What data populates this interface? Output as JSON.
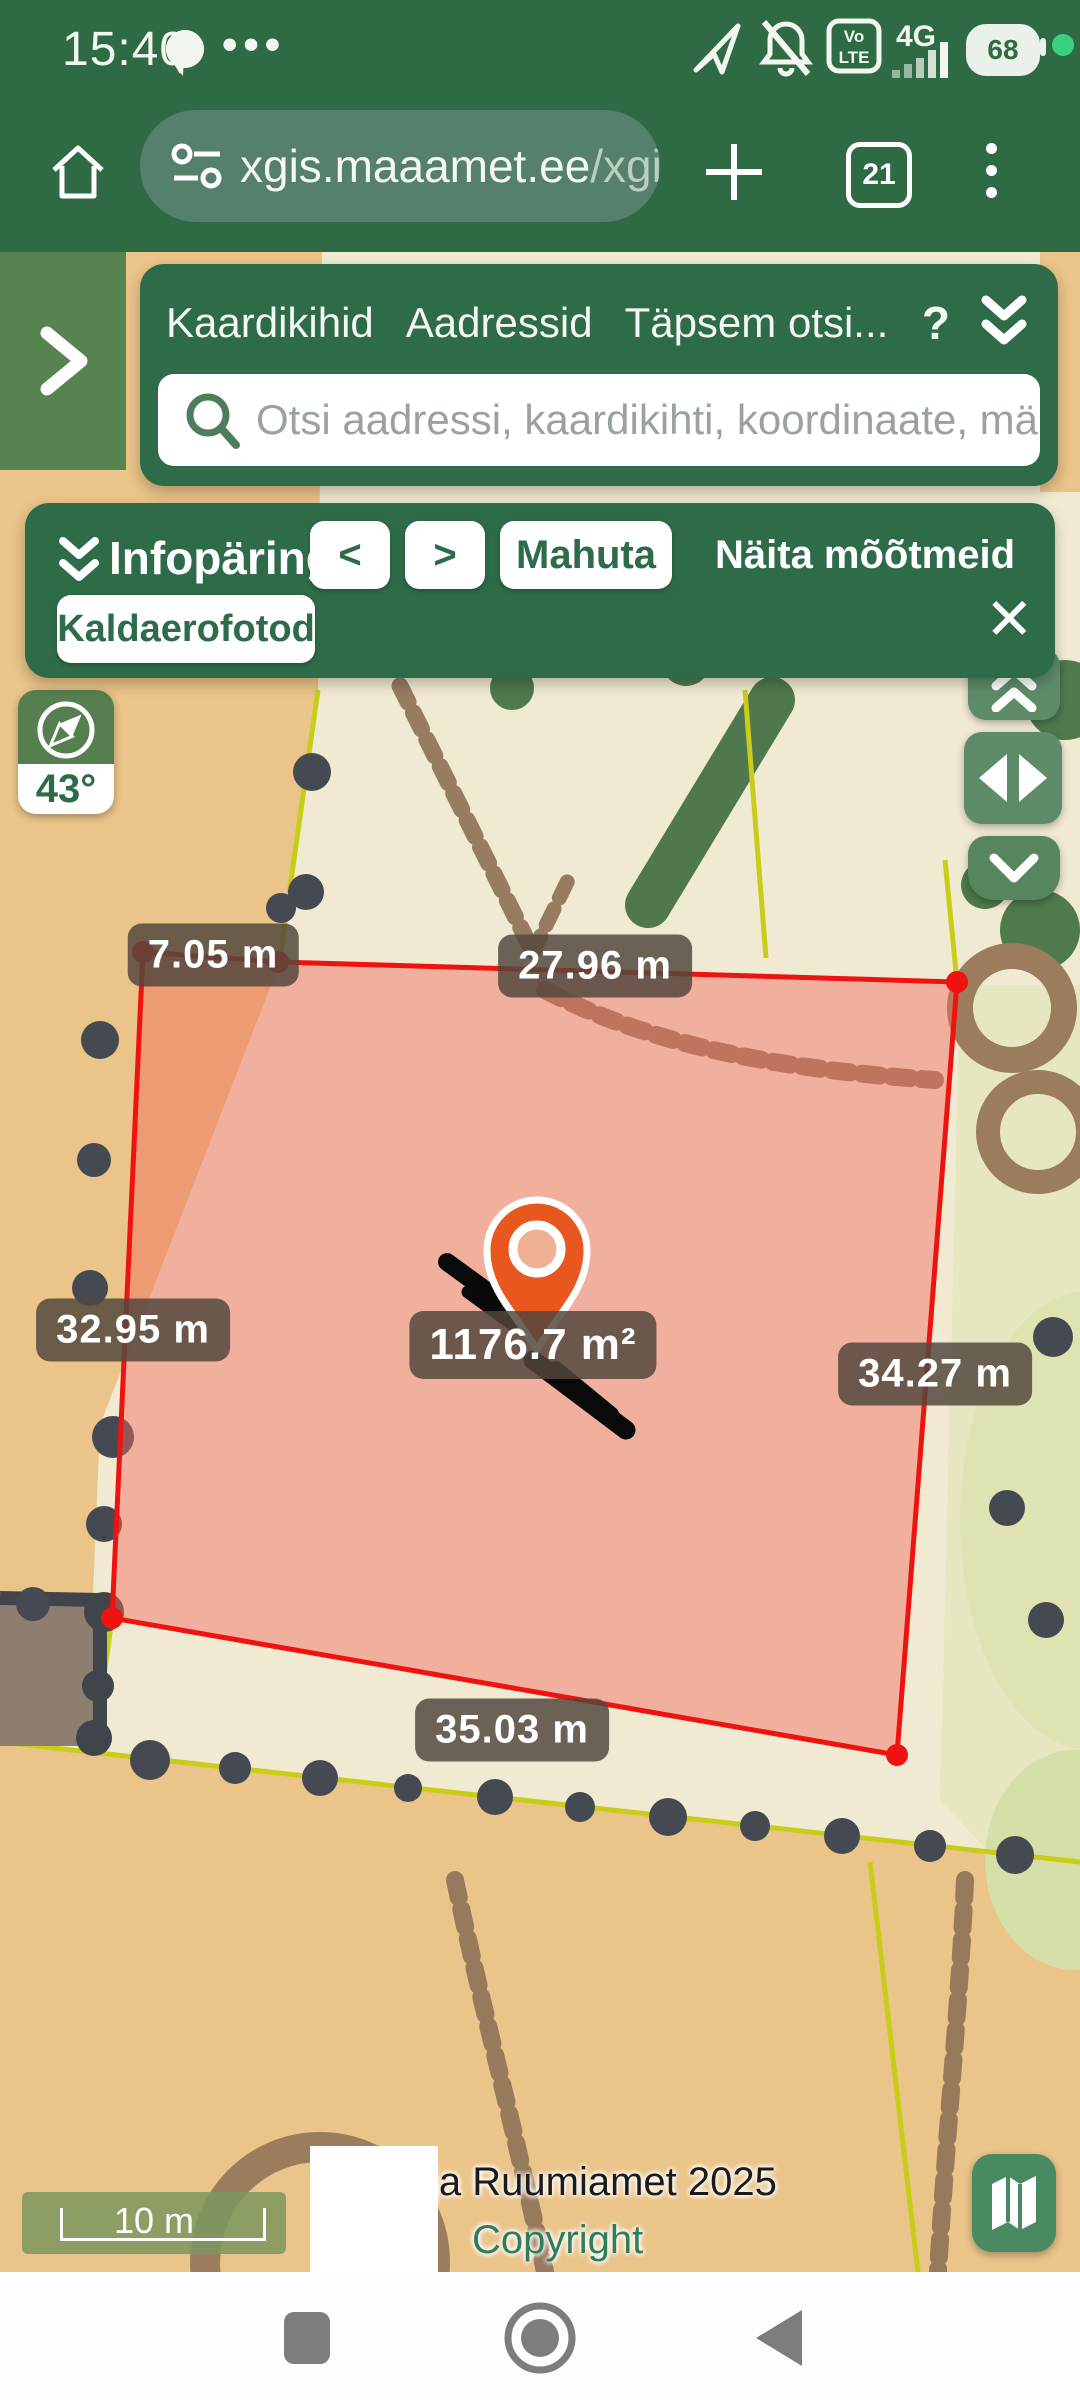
{
  "status_bar": {
    "time": "15:40",
    "overflow_dots": "•••",
    "volte_line1": "Vo",
    "volte_line2": "LTE",
    "network": "4G",
    "battery_percent": "68"
  },
  "browser": {
    "url_host": "xgis.maaamet.ee",
    "url_path": "/xgis:",
    "tab_count": "21"
  },
  "layer_panel": {
    "tabs": [
      "Kaardikihid",
      "Aadressid",
      "Täpsem otsi..."
    ],
    "help_label": "?",
    "search_placeholder": "Otsi aadressi, kaardikihti, koordinaate, mär..."
  },
  "info_panel": {
    "title": "Infopäring",
    "prev_label": "<",
    "next_label": ">",
    "fit_label": "Mahuta",
    "show_measurements_label": "Näita mõõtmeid",
    "layer_button_label": "Kaldaerofotod",
    "close_label": "✕",
    "expand_label": "›"
  },
  "map": {
    "compass_degrees": "43°",
    "area_label": "1176.7 m²",
    "measurements": [
      {
        "side": "top-left-segment",
        "text": "7.05 m"
      },
      {
        "side": "top",
        "text": "27.96 m"
      },
      {
        "side": "left",
        "text": "32.95 m"
      },
      {
        "side": "right",
        "text": "34.27 m"
      },
      {
        "side": "bottom",
        "text": "35.03 m"
      }
    ],
    "scale_label": "10 m",
    "attribution": "ja Ruumiamet 2025",
    "copyright": "Copyright"
  },
  "colors": {
    "chrome_green": "#2e6b45",
    "panel_green": "#2e6b48",
    "parcel_stroke": "#ee1311",
    "parcel_fill": "rgba(240,106,90,0.45)",
    "pin_orange": "#e8571d",
    "map_cream": "#f1ead3",
    "map_tan": "#eac488"
  }
}
